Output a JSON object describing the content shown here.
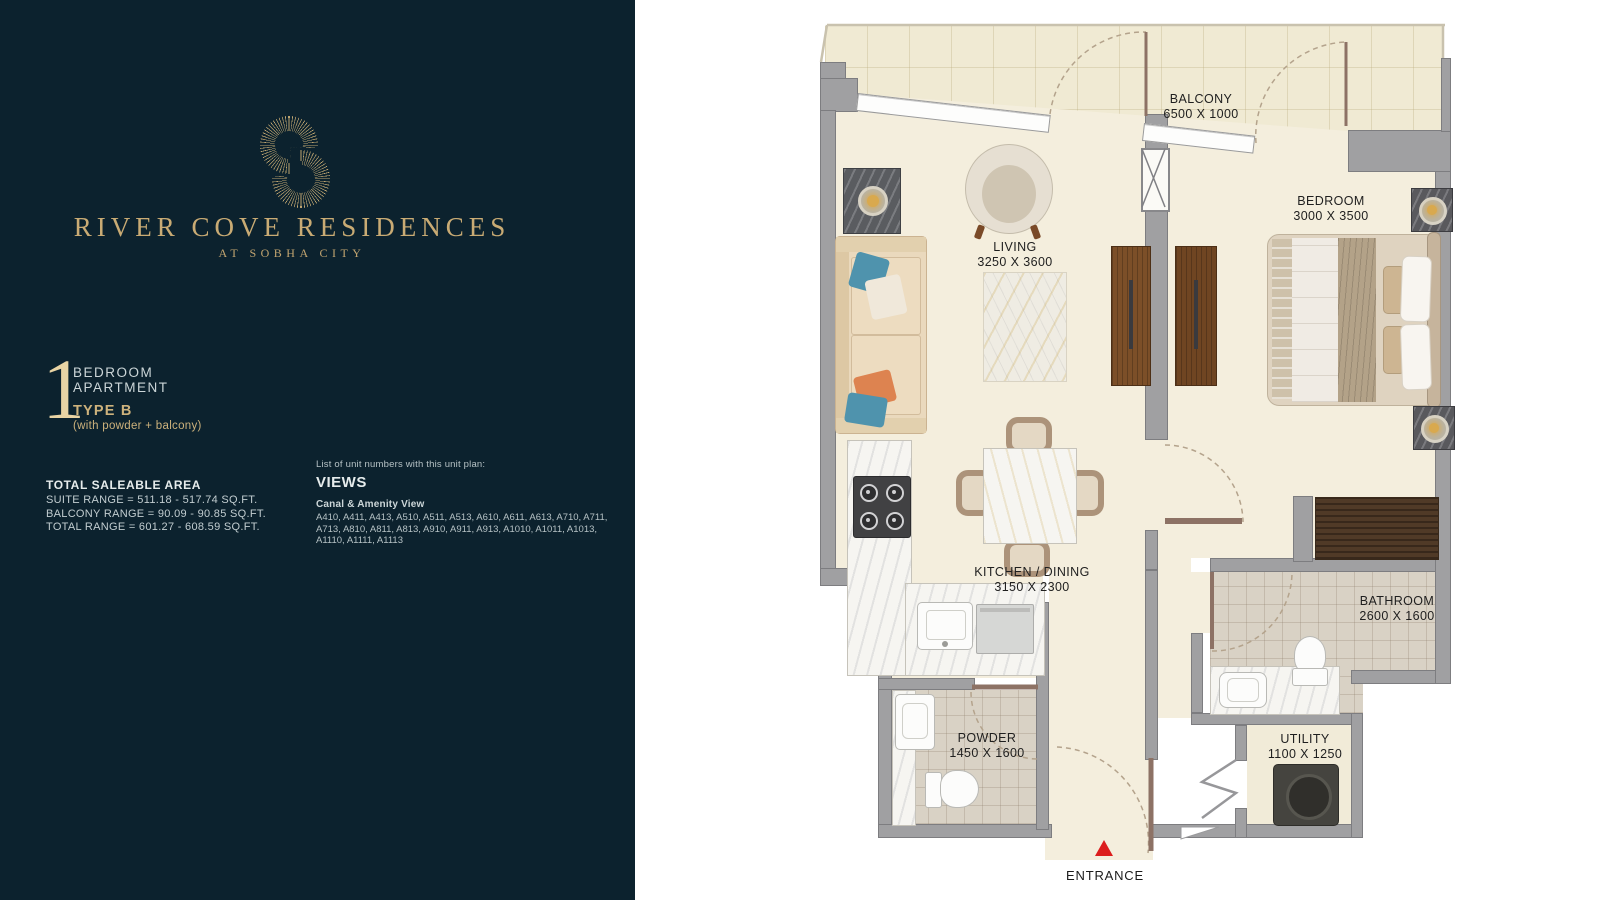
{
  "panel": {
    "logo": {
      "name": "RIVER COVE RESIDENCES",
      "tagline": "AT SOBHA CITY"
    },
    "unit": {
      "number": "1",
      "line1": "BEDROOM",
      "line2": "APARTMENT",
      "type": "TYPE B",
      "type_note": "(with powder + balcony)"
    },
    "area": {
      "heading": "TOTAL SALEABLE AREA",
      "rows": [
        "SUITE RANGE = 511.18 - 517.74 SQ.FT.",
        "BALCONY RANGE = 90.09 - 90.85 SQ.FT.",
        "TOTAL RANGE = 601.27 - 608.59 SQ.FT."
      ]
    },
    "views": {
      "intro": "List of unit numbers with this unit plan:",
      "heading": "VIEWS",
      "subheading": "Canal & Amenity View",
      "units": "A410, A411, A413, A510, A511, A513, A610, A611, A613, A710, A711, A713, A810, A811, A813, A910, A911, A913, A1010, A1011, A1013, A1110, A1111, A1113"
    }
  },
  "plan": {
    "rooms": {
      "balcony": {
        "name": "BALCONY",
        "dims": "6500 X 1000"
      },
      "living": {
        "name": "LIVING",
        "dims": "3250 X 3600"
      },
      "bedroom": {
        "name": "BEDROOM",
        "dims": "3000 X 3500"
      },
      "kitchen": {
        "name": "KITCHEN / DINING",
        "dims": "3150 X 2300"
      },
      "bathroom": {
        "name": "BATHROOM",
        "dims": "2600 X 1600"
      },
      "powder": {
        "name": "POWDER",
        "dims": "1450 X 1600"
      },
      "utility": {
        "name": "UTILITY",
        "dims": "1100 X 1250"
      }
    },
    "entrance_label": "ENTRANCE"
  },
  "colors": {
    "panel_bg": "#0c222e",
    "gold": "#c9ab74",
    "gold_light": "#e9d4a4",
    "text_light": "#e6ecec",
    "text_muted": "#b6c2c5",
    "wall_gray": "#a0a0a2",
    "floor_cream": "#f4eedd",
    "floor_tile": "#d9d2c5",
    "wood_brown": "#7c4f28",
    "accent_red": "#dc1d1d"
  }
}
